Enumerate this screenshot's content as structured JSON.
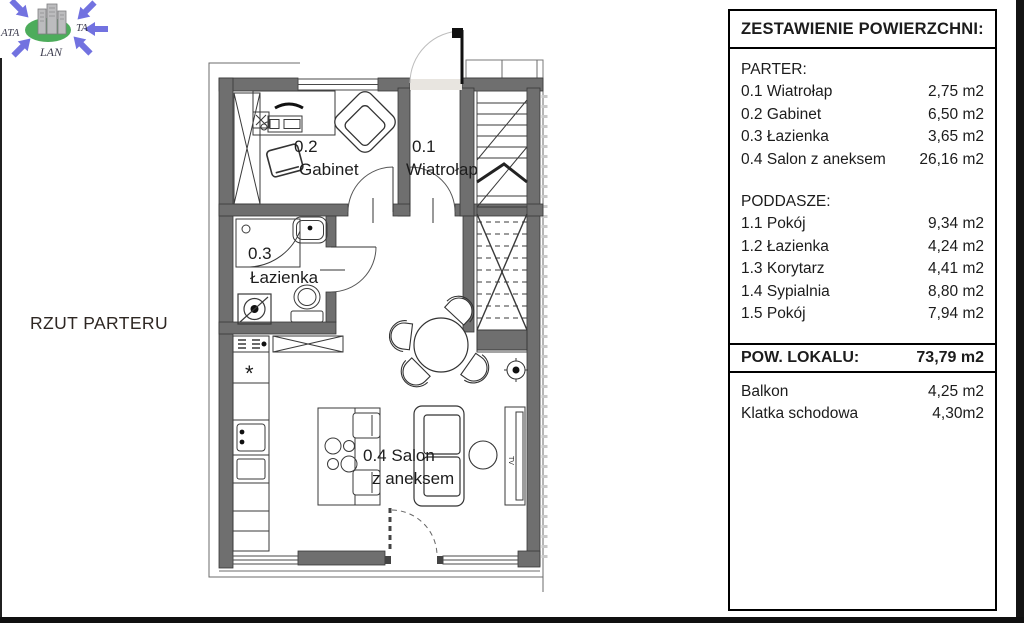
{
  "logo": {
    "left": "ATA",
    "right": "TA",
    "bottom": "LAN"
  },
  "plan": {
    "caption": "RZUT PARTERU",
    "labels": {
      "r01_num": "0.1",
      "r01_name": "Wiatrołap",
      "r02_num": "0.2",
      "r02_name": "Gabinet",
      "r03_num": "0.3",
      "r03_name": "Łazienka",
      "r04_line1": "0.4 Salon",
      "r04_line2": "z aneksem",
      "tv": "TV",
      "kitchen_star": "*"
    }
  },
  "panel": {
    "title": "ZESTAWIENIE POWIERZCHNI:",
    "parter": {
      "heading": "PARTER:",
      "rows": [
        {
          "label": "0.1 Wiatrołap",
          "value": "2,75 m2"
        },
        {
          "label": "0.2 Gabinet",
          "value": "6,50 m2"
        },
        {
          "label": "0.3 Łazienka",
          "value": "3,65 m2"
        },
        {
          "label": "0.4 Salon z aneksem",
          "value": "26,16 m2"
        }
      ]
    },
    "poddasze": {
      "heading": "PODDASZE:",
      "rows": [
        {
          "label": "1.1 Pokój",
          "value": "9,34 m2"
        },
        {
          "label": "1.2 Łazienka",
          "value": "4,24 m2"
        },
        {
          "label": "1.3 Korytarz",
          "value": "4,41 m2"
        },
        {
          "label": "1.4 Sypialnia",
          "value": "8,80 m2"
        },
        {
          "label": "1.5 Pokój",
          "value": "7,94 m2"
        }
      ]
    },
    "total": {
      "label": "POW. LOKALU:",
      "value": "73,79 m2"
    },
    "extras": [
      {
        "label": "Balkon",
        "value": "4,25 m2"
      },
      {
        "label": "Klatka schodowa",
        "value": "4,30m2"
      }
    ]
  },
  "colors": {
    "wall": "#6f6f6f",
    "line": "#3a3a3a",
    "accent_blue": "#7272e0",
    "accent_green": "#2e9e3e"
  }
}
